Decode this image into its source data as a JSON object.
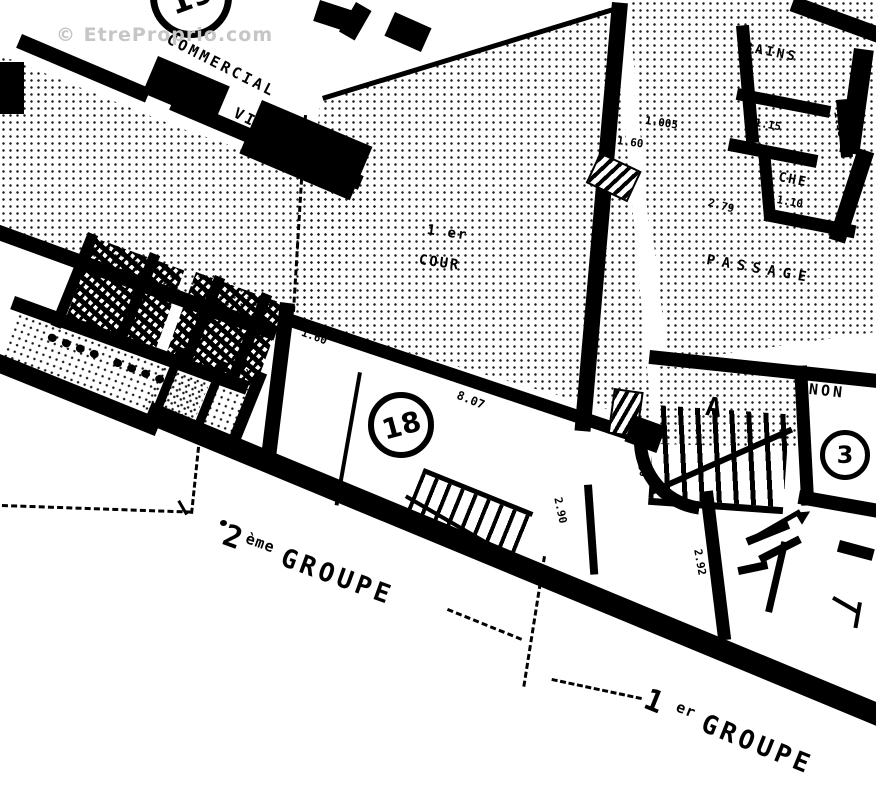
{
  "watermark": "© EtreProprio.com",
  "labels": {
    "building_top_line1": "COMMERCIAL",
    "building_top_line2": "NON VISITE",
    "courtyard_line1": "1 er",
    "courtyard_line2": "COUR",
    "passage": "PASSAGE",
    "bains": "BAINS",
    "wc": "WC",
    "wc_dim": "1.15",
    "che": "CHE",
    "che_dim": "1.10",
    "non": "NON",
    "stair_letter": "A"
  },
  "street_groups": {
    "group2": {
      "num": "2",
      "sup": "ème",
      "word": "GROUPE"
    },
    "group1": {
      "num": "1",
      "sup": "er",
      "word": "GROUPE"
    }
  },
  "unit_circles": {
    "c19": "19",
    "c18": "18",
    "c3": "3"
  },
  "dimensions": [
    {
      "v": "8.07"
    },
    {
      "v": "1.60"
    },
    {
      "v": "1.005"
    },
    {
      "v": "1.60"
    },
    {
      "v": "2.79"
    },
    {
      "v": "2.90"
    },
    {
      "v": "2.92"
    },
    {
      "v": "1.33"
    },
    {
      "v": "1.50"
    },
    {
      "v": "2.32"
    }
  ]
}
